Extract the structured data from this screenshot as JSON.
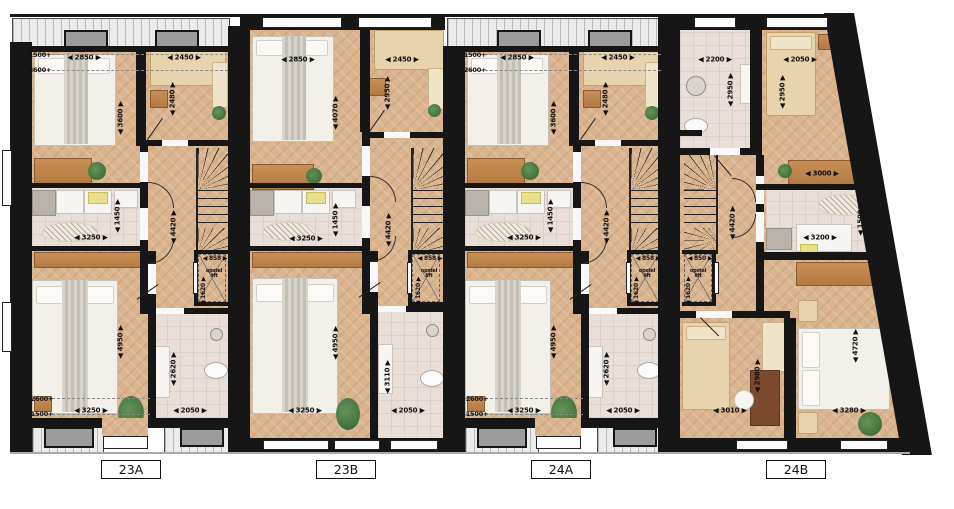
{
  "plan": {
    "palette": {
      "wall": "#161616",
      "wood_floor": "#d9b48e",
      "tile_floor": "#eadfd8",
      "roof_hatch": "#ebebeb",
      "dormer": "#9c9c9c",
      "label_text": "#111111"
    },
    "units": [
      {
        "id": "23A",
        "label": "23A"
      },
      {
        "id": "23B",
        "label": "23B"
      },
      {
        "id": "24A",
        "label": "24A"
      },
      {
        "id": "24B",
        "label": "24B"
      }
    ],
    "dimensions": [
      {
        "unit": "23A",
        "text": "1500+",
        "type": "plain",
        "x": 40,
        "y": 55
      },
      {
        "unit": "23A",
        "text": "2600+",
        "type": "plain",
        "x": 40,
        "y": 70
      },
      {
        "unit": "23A",
        "text": "2850",
        "type": "h",
        "x": 84,
        "y": 58
      },
      {
        "unit": "23A",
        "text": "2450",
        "type": "h",
        "x": 184,
        "y": 58
      },
      {
        "unit": "23A",
        "text": "2480",
        "type": "v",
        "x": 173,
        "y": 99
      },
      {
        "unit": "23A",
        "text": "3600",
        "type": "v",
        "x": 121,
        "y": 118
      },
      {
        "unit": "23A",
        "text": "1450",
        "type": "v",
        "x": 118,
        "y": 216
      },
      {
        "unit": "23A",
        "text": "3250",
        "type": "h",
        "x": 91,
        "y": 238
      },
      {
        "unit": "23A",
        "text": "4420",
        "type": "v",
        "x": 174,
        "y": 227
      },
      {
        "unit": "23A",
        "text": "858",
        "type": "hs",
        "x": 215,
        "y": 259
      },
      {
        "unit": "23A",
        "text": "opstel lift",
        "type": "lift",
        "x": 214,
        "y": 274
      },
      {
        "unit": "23A",
        "text": "1620",
        "type": "vs",
        "x": 204,
        "y": 291
      },
      {
        "unit": "23A",
        "text": "4950",
        "type": "v",
        "x": 121,
        "y": 342
      },
      {
        "unit": "23A",
        "text": "2620",
        "type": "v",
        "x": 174,
        "y": 369
      },
      {
        "unit": "23A",
        "text": "2600+",
        "type": "plain",
        "x": 42,
        "y": 399
      },
      {
        "unit": "23A",
        "text": "1500+",
        "type": "plain",
        "x": 42,
        "y": 414
      },
      {
        "unit": "23A",
        "text": "3250",
        "type": "h",
        "x": 91,
        "y": 411
      },
      {
        "unit": "23A",
        "text": "2050",
        "type": "h",
        "x": 190,
        "y": 411
      },
      {
        "unit": "23B",
        "text": "2850",
        "type": "h",
        "x": 298,
        "y": 60
      },
      {
        "unit": "23B",
        "text": "2450",
        "type": "h",
        "x": 402,
        "y": 60
      },
      {
        "unit": "23B",
        "text": "4070",
        "type": "v",
        "x": 336,
        "y": 113
      },
      {
        "unit": "23B",
        "text": "2950",
        "type": "v",
        "x": 388,
        "y": 93
      },
      {
        "unit": "23B",
        "text": "1450",
        "type": "v",
        "x": 336,
        "y": 220
      },
      {
        "unit": "23B",
        "text": "3250",
        "type": "h",
        "x": 306,
        "y": 239
      },
      {
        "unit": "23B",
        "text": "4420",
        "type": "v",
        "x": 389,
        "y": 230
      },
      {
        "unit": "23B",
        "text": "858",
        "type": "hs",
        "x": 430,
        "y": 259
      },
      {
        "unit": "23B",
        "text": "opstel lift",
        "type": "lift",
        "x": 429,
        "y": 274
      },
      {
        "unit": "23B",
        "text": "1620",
        "type": "vs",
        "x": 419,
        "y": 291
      },
      {
        "unit": "23B",
        "text": "4950",
        "type": "v",
        "x": 336,
        "y": 343
      },
      {
        "unit": "23B",
        "text": "3110",
        "type": "v",
        "x": 388,
        "y": 377
      },
      {
        "unit": "23B",
        "text": "3250",
        "type": "h",
        "x": 305,
        "y": 411
      },
      {
        "unit": "23B",
        "text": "2050",
        "type": "h",
        "x": 408,
        "y": 411
      },
      {
        "unit": "24A",
        "text": "1500+",
        "type": "plain",
        "x": 475,
        "y": 55
      },
      {
        "unit": "24A",
        "text": "2600+",
        "type": "plain",
        "x": 475,
        "y": 70
      },
      {
        "unit": "24A",
        "text": "2850",
        "type": "h",
        "x": 517,
        "y": 58
      },
      {
        "unit": "24A",
        "text": "2450",
        "type": "h",
        "x": 618,
        "y": 58
      },
      {
        "unit": "24A",
        "text": "2480",
        "type": "v",
        "x": 606,
        "y": 99
      },
      {
        "unit": "24A",
        "text": "3600",
        "type": "v",
        "x": 554,
        "y": 118
      },
      {
        "unit": "24A",
        "text": "1450",
        "type": "v",
        "x": 551,
        "y": 216
      },
      {
        "unit": "24A",
        "text": "3250",
        "type": "h",
        "x": 524,
        "y": 238
      },
      {
        "unit": "24A",
        "text": "4420",
        "type": "v",
        "x": 607,
        "y": 227
      },
      {
        "unit": "24A",
        "text": "858",
        "type": "hs",
        "x": 648,
        "y": 259
      },
      {
        "unit": "24A",
        "text": "opstel lift",
        "type": "lift",
        "x": 647,
        "y": 274
      },
      {
        "unit": "24A",
        "text": "1620",
        "type": "vs",
        "x": 637,
        "y": 291
      },
      {
        "unit": "24A",
        "text": "4950",
        "type": "v",
        "x": 554,
        "y": 342
      },
      {
        "unit": "24A",
        "text": "2620",
        "type": "v",
        "x": 607,
        "y": 369
      },
      {
        "unit": "24A",
        "text": "2600+",
        "type": "plain",
        "x": 477,
        "y": 399
      },
      {
        "unit": "24A",
        "text": "1500+",
        "type": "plain",
        "x": 477,
        "y": 414
      },
      {
        "unit": "24A",
        "text": "3250",
        "type": "h",
        "x": 524,
        "y": 411
      },
      {
        "unit": "24A",
        "text": "2050",
        "type": "h",
        "x": 623,
        "y": 411
      },
      {
        "unit": "24B",
        "text": "2200",
        "type": "h",
        "x": 715,
        "y": 60
      },
      {
        "unit": "24B",
        "text": "2050",
        "type": "h",
        "x": 800,
        "y": 60
      },
      {
        "unit": "24B",
        "text": "2950",
        "type": "v",
        "x": 731,
        "y": 90
      },
      {
        "unit": "24B",
        "text": "2950",
        "type": "v",
        "x": 783,
        "y": 92
      },
      {
        "unit": "24B",
        "text": "3000",
        "type": "h",
        "x": 822,
        "y": 174
      },
      {
        "unit": "24B",
        "text": "1500",
        "type": "v",
        "x": 861,
        "y": 219
      },
      {
        "unit": "24B",
        "text": "3200",
        "type": "h",
        "x": 820,
        "y": 238
      },
      {
        "unit": "24B",
        "text": "4420",
        "type": "v",
        "x": 733,
        "y": 223
      },
      {
        "unit": "24B",
        "text": "850",
        "type": "hs",
        "x": 700,
        "y": 259
      },
      {
        "unit": "24B",
        "text": "opstel lift",
        "type": "lift",
        "x": 698,
        "y": 274
      },
      {
        "unit": "24B",
        "text": "1620",
        "type": "vs",
        "x": 689,
        "y": 291
      },
      {
        "unit": "24B",
        "text": "2980",
        "type": "v",
        "x": 758,
        "y": 376
      },
      {
        "unit": "24B",
        "text": "3010",
        "type": "h",
        "x": 730,
        "y": 411
      },
      {
        "unit": "24B",
        "text": "4720",
        "type": "v",
        "x": 856,
        "y": 346
      },
      {
        "unit": "24B",
        "text": "3280",
        "type": "h",
        "x": 849,
        "y": 411
      }
    ]
  }
}
